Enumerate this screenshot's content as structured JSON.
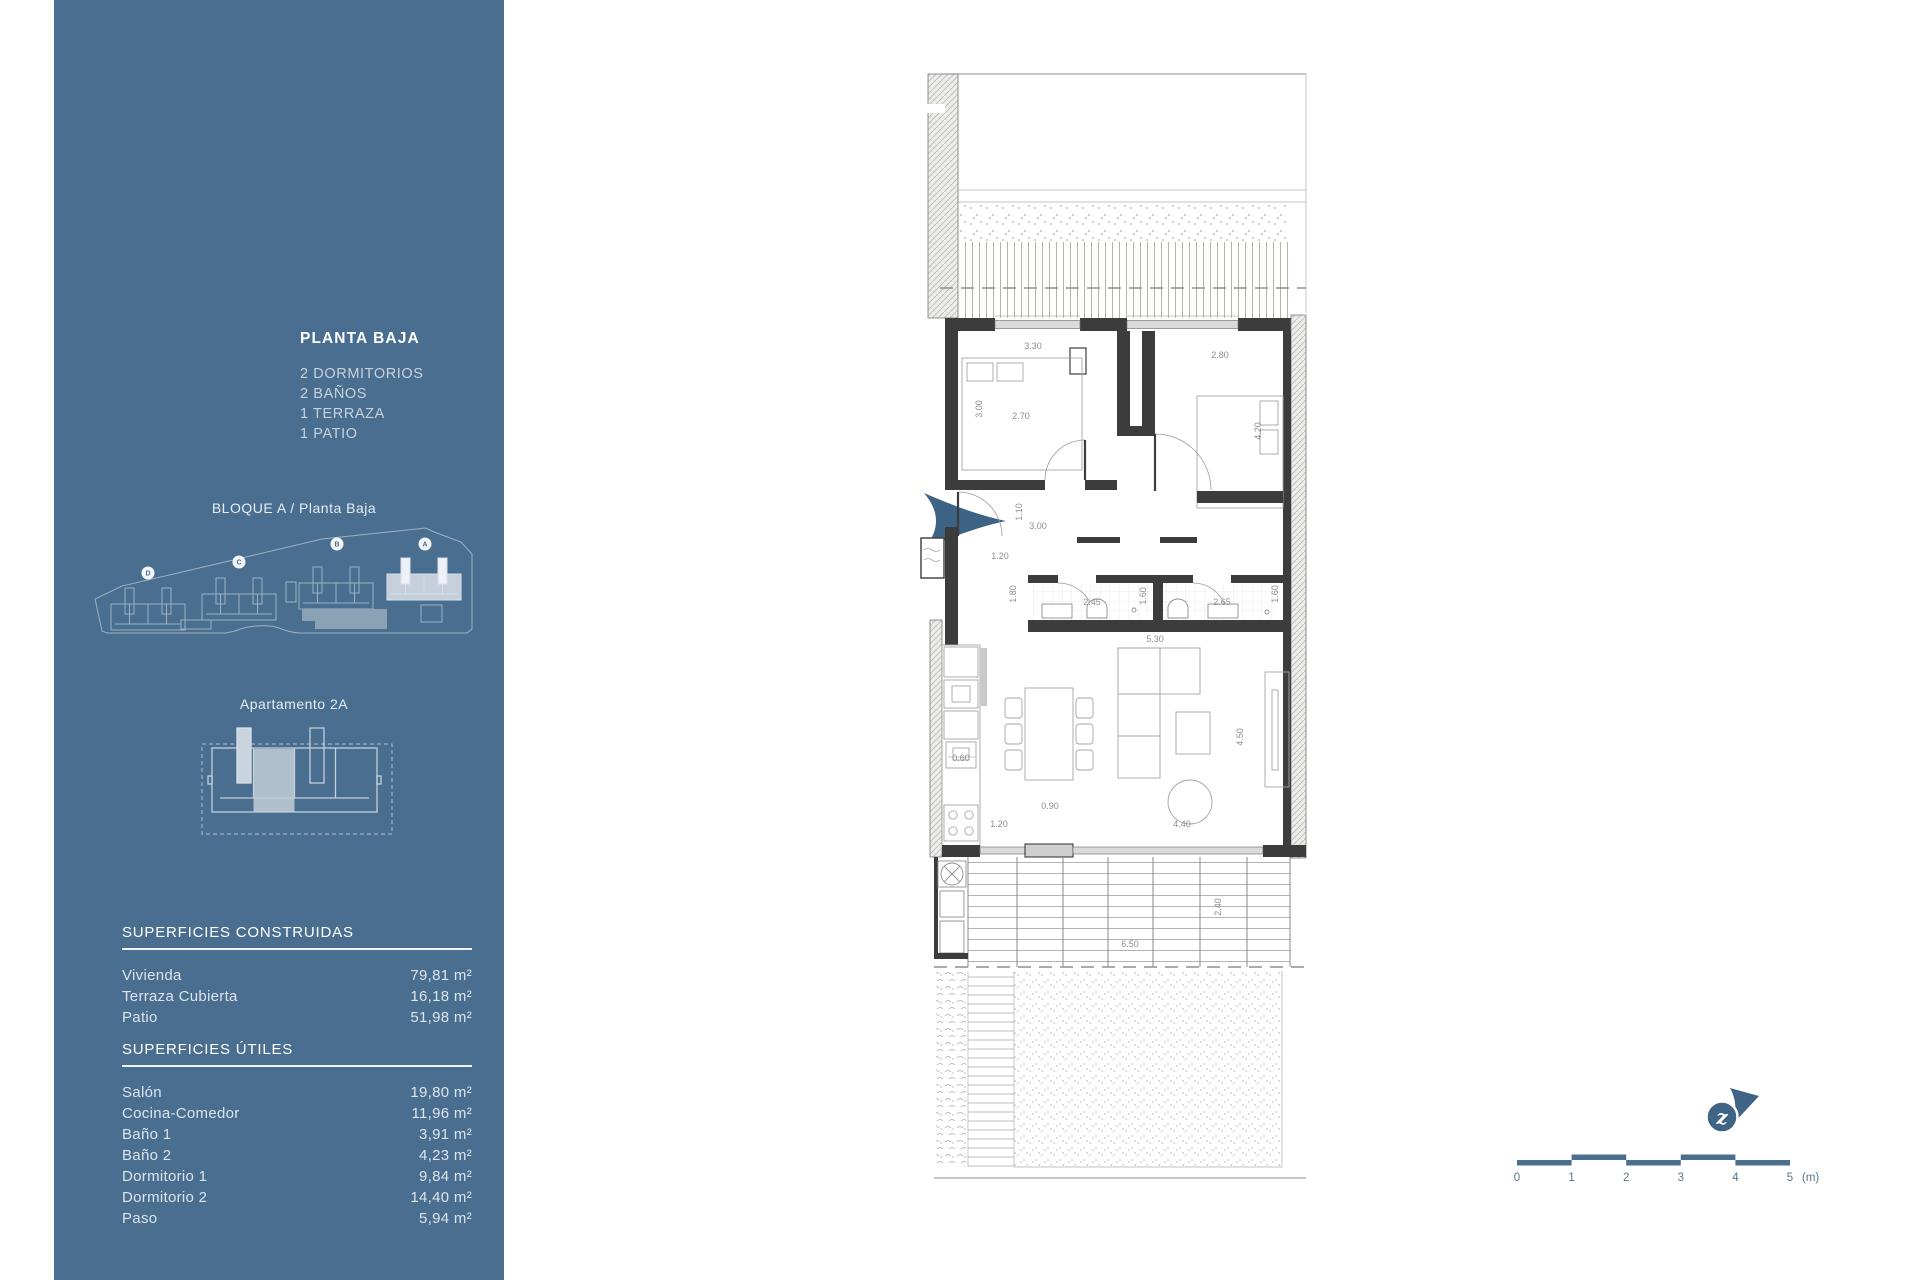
{
  "sidebar": {
    "title": "PLANTA BAJA",
    "features": [
      "2 DORMITORIOS",
      "2 BAÑOS",
      "1 TERRAZA",
      "1 PATIO"
    ],
    "block_label": "BLOQUE A / Planta Baja",
    "site_buildings": [
      "D",
      "C",
      "B",
      "A"
    ],
    "apartment_label": "Apartamento 2A",
    "built_areas": {
      "heading": "SUPERFICIES CONSTRUIDAS",
      "rows": [
        {
          "label": "Vivienda",
          "value": "79,81 m²"
        },
        {
          "label": "Terraza Cubierta",
          "value": "16,18 m²"
        },
        {
          "label": "Patio",
          "value": "51,98 m²"
        }
      ]
    },
    "usable_areas": {
      "heading": "SUPERFICIES ÚTILES",
      "rows": [
        {
          "label": "Salón",
          "value": "19,80 m²"
        },
        {
          "label": "Cocina-Comedor",
          "value": "11,96 m²"
        },
        {
          "label": "Baño 1",
          "value": "3,91 m²"
        },
        {
          "label": "Baño 2",
          "value": "4,23 m²"
        },
        {
          "label": "Dormitorio 1",
          "value": "9,84 m²"
        },
        {
          "label": "Dormitorio 2",
          "value": "14,40 m²"
        },
        {
          "label": "Paso",
          "value": "5,94 m²"
        }
      ]
    }
  },
  "plan": {
    "dimensions": [
      {
        "text": "3.30",
        "x": 113,
        "y": 289
      },
      {
        "text": "3.00",
        "x": 62,
        "y": 349,
        "rot": -90
      },
      {
        "text": "2.70",
        "x": 101,
        "y": 359
      },
      {
        "text": "2.80",
        "x": 300,
        "y": 298
      },
      {
        "text": "4.20",
        "x": 341,
        "y": 371,
        "rot": -90
      },
      {
        "text": "1.10",
        "x": 102,
        "y": 452,
        "rot": -90
      },
      {
        "text": "3.00",
        "x": 118,
        "y": 469
      },
      {
        "text": "1.20",
        "x": 80,
        "y": 499
      },
      {
        "text": "1.80",
        "x": 96,
        "y": 534,
        "rot": -90
      },
      {
        "text": "2.45",
        "x": 172,
        "y": 545
      },
      {
        "text": "1.60",
        "x": 226,
        "y": 536,
        "rot": -90
      },
      {
        "text": "2.65",
        "x": 302,
        "y": 545
      },
      {
        "text": "1.60",
        "x": 358,
        "y": 534,
        "rot": -90
      },
      {
        "text": "5.30",
        "x": 235,
        "y": 582
      },
      {
        "text": "0.60",
        "x": 41,
        "y": 701
      },
      {
        "text": "0.90",
        "x": 130,
        "y": 749
      },
      {
        "text": "1.20",
        "x": 79,
        "y": 767
      },
      {
        "text": "4.40",
        "x": 262,
        "y": 767
      },
      {
        "text": "4.50",
        "x": 323,
        "y": 677,
        "rot": -90
      },
      {
        "text": "2.40",
        "x": 301,
        "y": 847,
        "rot": -90
      },
      {
        "text": "6.50",
        "x": 210,
        "y": 887
      }
    ]
  },
  "north": {
    "letter": "z"
  },
  "scale_bar": {
    "labels": [
      "0",
      "1",
      "2",
      "3",
      "4",
      "5"
    ],
    "unit": "(m)"
  },
  "colors": {
    "sidebar": "#4a6e8f",
    "accent_arrow": "#3d6384",
    "wall": "#3c3c3c"
  }
}
